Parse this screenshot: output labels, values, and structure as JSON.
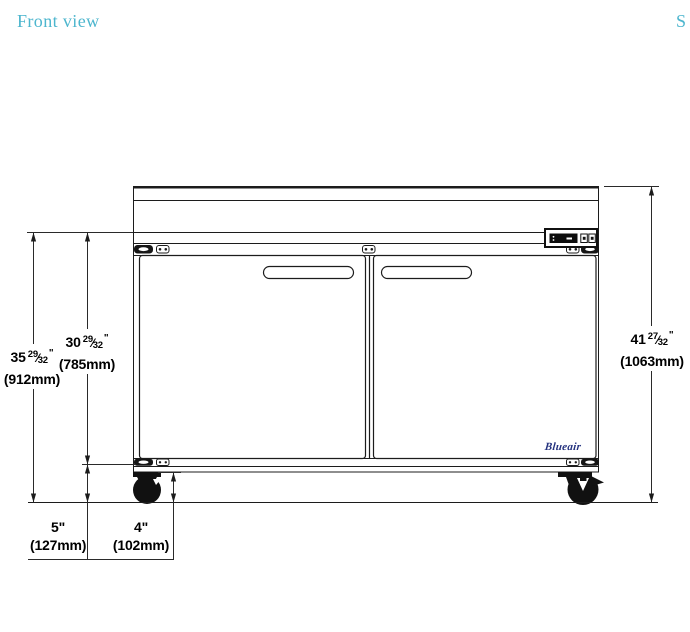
{
  "header": {
    "title": "Front view",
    "next_view_partial": "S"
  },
  "symbols": {
    "inch_mark": "\"",
    "fraction_slash": "⁄"
  },
  "unit": {
    "brand_logo": "Blueair"
  },
  "dimensions": {
    "overall_height": {
      "inches_whole": "41",
      "frac_num": "27",
      "frac_den": "32",
      "metric": "(1063mm)"
    },
    "body_height_with_casters": {
      "inches_whole": "35",
      "frac_num": "29",
      "frac_den": "32",
      "metric": "(912mm)"
    },
    "body_height": {
      "inches_whole": "30",
      "frac_num": "29",
      "frac_den": "32",
      "metric": "(785mm)"
    },
    "caster_overall_height": {
      "inches_whole": "5",
      "metric": "(127mm)"
    },
    "caster_wheel_diameter": {
      "inches_whole": "4",
      "metric": "(102mm)"
    }
  },
  "colors": {
    "accent_teal": "#4db6ce",
    "drawing_line": "#1c1c1c",
    "logo_navy": "#23317e"
  }
}
